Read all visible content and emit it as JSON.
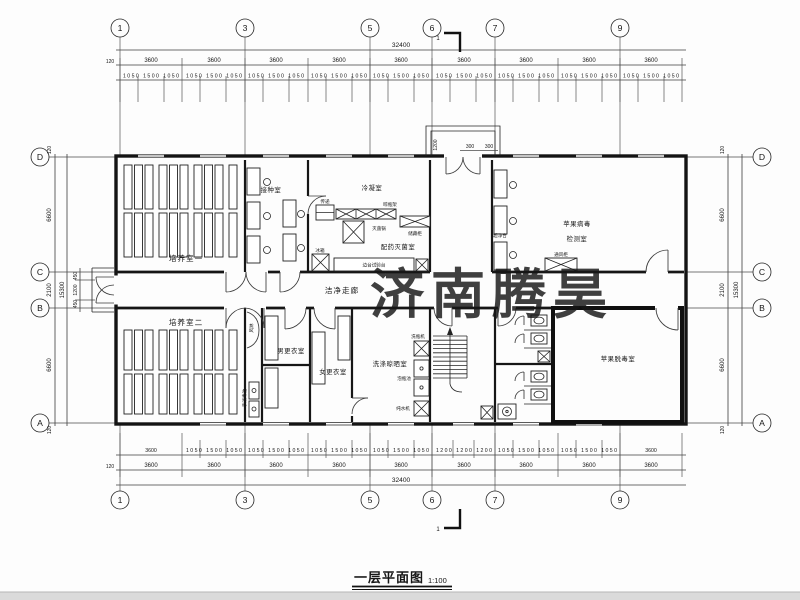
{
  "meta": {
    "watermark": "济南腾昊",
    "watermark_color": "#e15151",
    "title": "一层平面图",
    "scale": "1:100",
    "section_mark": "1"
  },
  "grid": {
    "top": [
      "1",
      "3",
      "5",
      "6",
      "7",
      "9"
    ],
    "side": [
      "D",
      "C",
      "B",
      "A"
    ]
  },
  "dims": {
    "total_w": "32400",
    "total_h": "15300",
    "bay": "3600",
    "offset": "120",
    "top_detail_bays": [
      "1050 1500 1050",
      "1050 1500 1050",
      "1050 1500 1050",
      "1050 1500 1050",
      "1050 1500 1050",
      "1050 1500 1050",
      "1050 1500 1050",
      "1050 1500 1050",
      "1050 1500 1050"
    ],
    "bottom_detail_bays": [
      "3600",
      "1050 1500 1050",
      "1050 1500 1050",
      "1050 1500 1050",
      "1050 1500 1050",
      "1200 1200 1200",
      "1050 1500 1050",
      "1050 1500 1050",
      "3600"
    ],
    "left": {
      "offset_top": "120",
      "d_c": "6600",
      "c_b": "2100",
      "b_a": "6600",
      "offset_bottom": "120",
      "total": "15300",
      "c_b_sub": [
        "450",
        "1200",
        "450"
      ]
    },
    "right": {
      "offset_top": "120",
      "d_c": "6600",
      "c_b": "2100",
      "b_a": "6600",
      "offset_bottom": "120",
      "total": "15300"
    },
    "entrance": {
      "depth": "1200",
      "side_a": "300",
      "side_b": "300"
    }
  },
  "rooms": {
    "culture1": "培养室一",
    "culture2": "培养室二",
    "inoculation": "接种室",
    "condensation": "冷凝室",
    "sterilization": "配药灭菌室",
    "corridor": "洁净走廊",
    "detection_l1": "苹果病毒",
    "detection_l2": "检测室",
    "men": "男更衣室",
    "women": "女更衣室",
    "washing": "洗涤晾晒室",
    "detox": "苹果脱毒室"
  },
  "equipment": {
    "pass": "传递",
    "rack": "晾瓶架",
    "sterilizer": "灭菌锅",
    "cabinet": "储藏柜",
    "bench": "边台试验台",
    "fridge": "冰箱",
    "clean_bench": "超净台",
    "fume": "通风柜",
    "air_shower": "风淋",
    "washer": "洗瓶机",
    "soak": "泡瓶池",
    "purifier": "纯水机",
    "sanitizer": "手消毒池"
  }
}
